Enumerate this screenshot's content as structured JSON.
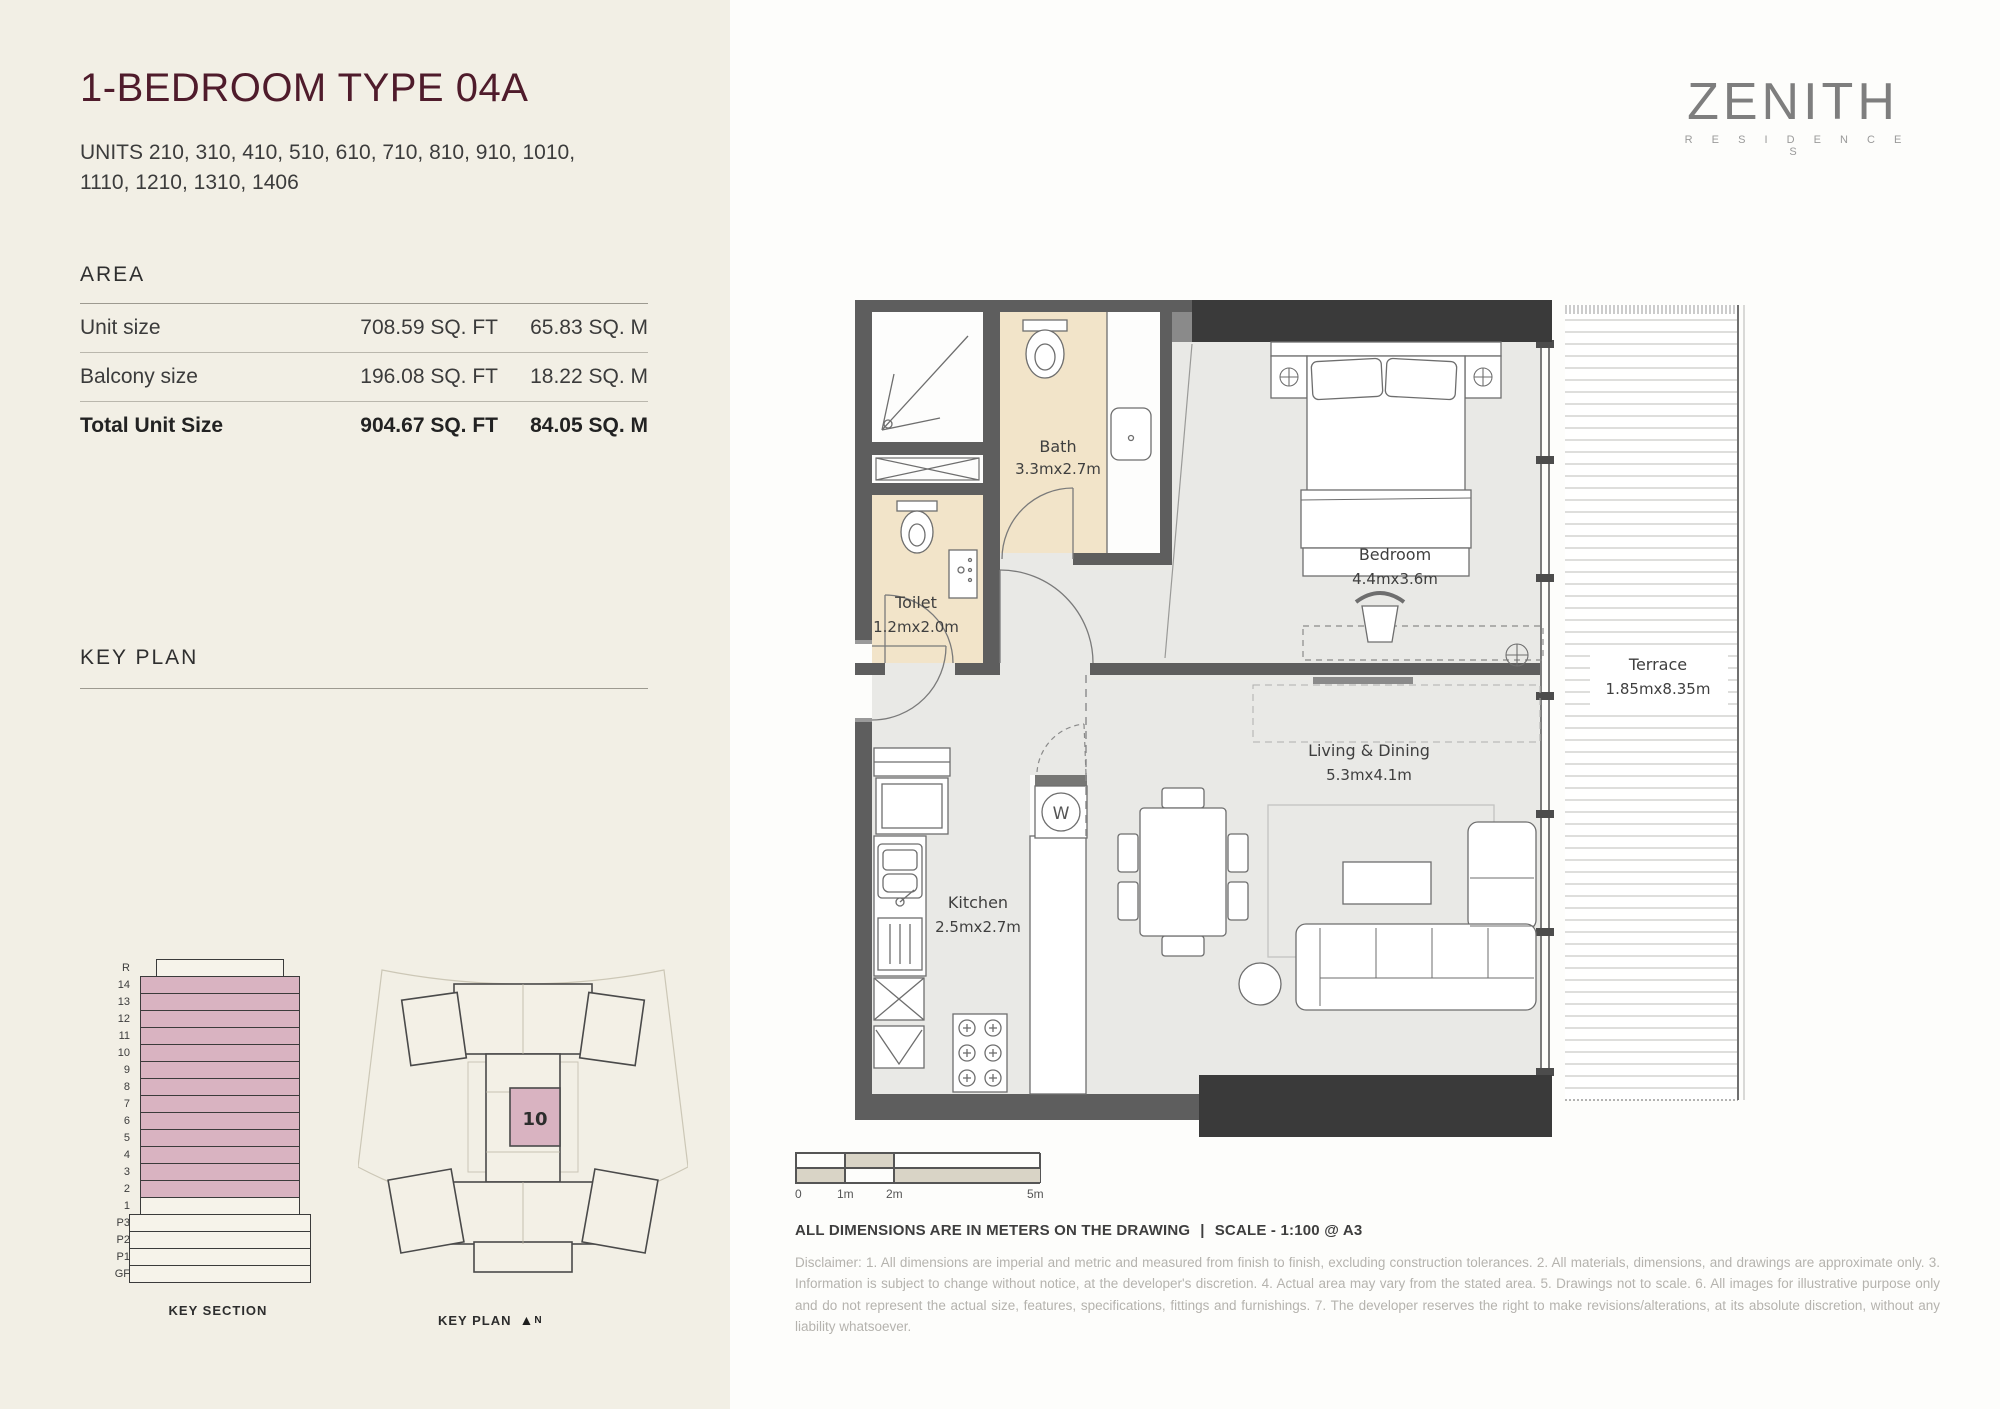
{
  "brand": {
    "name": "ZENITH",
    "sub": "R E S I D E N C E S"
  },
  "header": {
    "title": "1-BEDROOM TYPE 04A",
    "units": "UNITS 210, 310, 410, 510, 610, 710, 810, 910, 1010, 1110, 1210, 1310, 1406"
  },
  "area": {
    "heading": "AREA",
    "rows": [
      {
        "label": "Unit size",
        "sqft": "708.59 SQ. FT",
        "sqm": "65.83 SQ. M"
      },
      {
        "label": "Balcony size",
        "sqft": "196.08 SQ. FT",
        "sqm": "18.22 SQ. M"
      }
    ],
    "total": {
      "label": "Total Unit Size",
      "sqft": "904.67 SQ. FT",
      "sqm": "84.05 SQ. M"
    }
  },
  "key_plan": {
    "heading": "KEY PLAN",
    "section_caption": "KEY SECTION",
    "plan_caption": "KEY PLAN",
    "north_icon": "▲",
    "north": "N",
    "unit_number": "10",
    "highlight_color": "#d9b3c1",
    "floors": [
      {
        "label": "R",
        "kind": "roof"
      },
      {
        "label": "14",
        "kind": "pink"
      },
      {
        "label": "13",
        "kind": "pink"
      },
      {
        "label": "12",
        "kind": "pink"
      },
      {
        "label": "11",
        "kind": "pink"
      },
      {
        "label": "10",
        "kind": "pink"
      },
      {
        "label": "9",
        "kind": "pink"
      },
      {
        "label": "8",
        "kind": "pink"
      },
      {
        "label": "7",
        "kind": "pink"
      },
      {
        "label": "6",
        "kind": "pink"
      },
      {
        "label": "5",
        "kind": "pink"
      },
      {
        "label": "4",
        "kind": "pink"
      },
      {
        "label": "3",
        "kind": "pink"
      },
      {
        "label": "2",
        "kind": "pink"
      },
      {
        "label": "1",
        "kind": "tower"
      },
      {
        "label": "P3",
        "kind": "podium"
      },
      {
        "label": "P2",
        "kind": "podium"
      },
      {
        "label": "P1",
        "kind": "podium"
      },
      {
        "label": "GF",
        "kind": "podium"
      }
    ]
  },
  "floor_plan": {
    "washer_label": "W",
    "rooms": {
      "bath": {
        "name": "Bath",
        "dims": "3.3mx2.7m"
      },
      "toilet": {
        "name": "Toilet",
        "dims": "1.2mx2.0m"
      },
      "bedroom": {
        "name": "Bedroom",
        "dims": "4.4mx3.6m"
      },
      "living": {
        "name": "Living & Dining",
        "dims": "5.3mx4.1m"
      },
      "kitchen": {
        "name": "Kitchen",
        "dims": "2.5mx2.7m"
      },
      "terrace": {
        "name": "Terrace",
        "dims": "1.85mx8.35m"
      }
    }
  },
  "scale_bar": {
    "labels": [
      "0",
      "1m",
      "2m",
      "5m"
    ]
  },
  "footer": {
    "dimensions_note": "ALL DIMENSIONS ARE IN METERS ON THE DRAWING",
    "separator": "|",
    "scale_note": "SCALE - 1:100 @ A3",
    "disclaimer": "Disclaimer: 1. All dimensions are imperial and metric and measured from finish to finish, excluding construction tolerances. 2. All materials, dimensions, and drawings are approximate only. 3. Information is subject to change without notice, at the developer's discretion. 4. Actual area may vary from the stated area. 5. Drawings not to scale. 6. All images for illustrative purpose only and do not represent the actual size, features, specifications, fittings and furnishings. 7. The developer reserves the right to make revisions/alterations, at its absolute discretion, without any liability whatsoever."
  }
}
